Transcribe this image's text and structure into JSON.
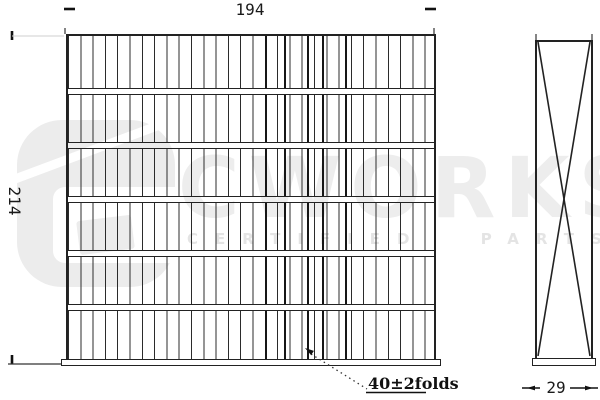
{
  "drawing": {
    "type": "cabin-air-filter technical drawing, front and side orthographic views",
    "front_view": {
      "width_dim": "194",
      "height_dim": "214",
      "pleat_rows": 6,
      "folds_note": "40±2folds"
    },
    "side_view": {
      "depth_dim": "29",
      "brace": "X cross"
    }
  },
  "watermark": {
    "brand": "CWORKS",
    "tagline": "CERTIFIED PARTS"
  },
  "colors": {
    "line": "#222222",
    "background": "#ffffff",
    "watermark_gray": "#ededed"
  }
}
